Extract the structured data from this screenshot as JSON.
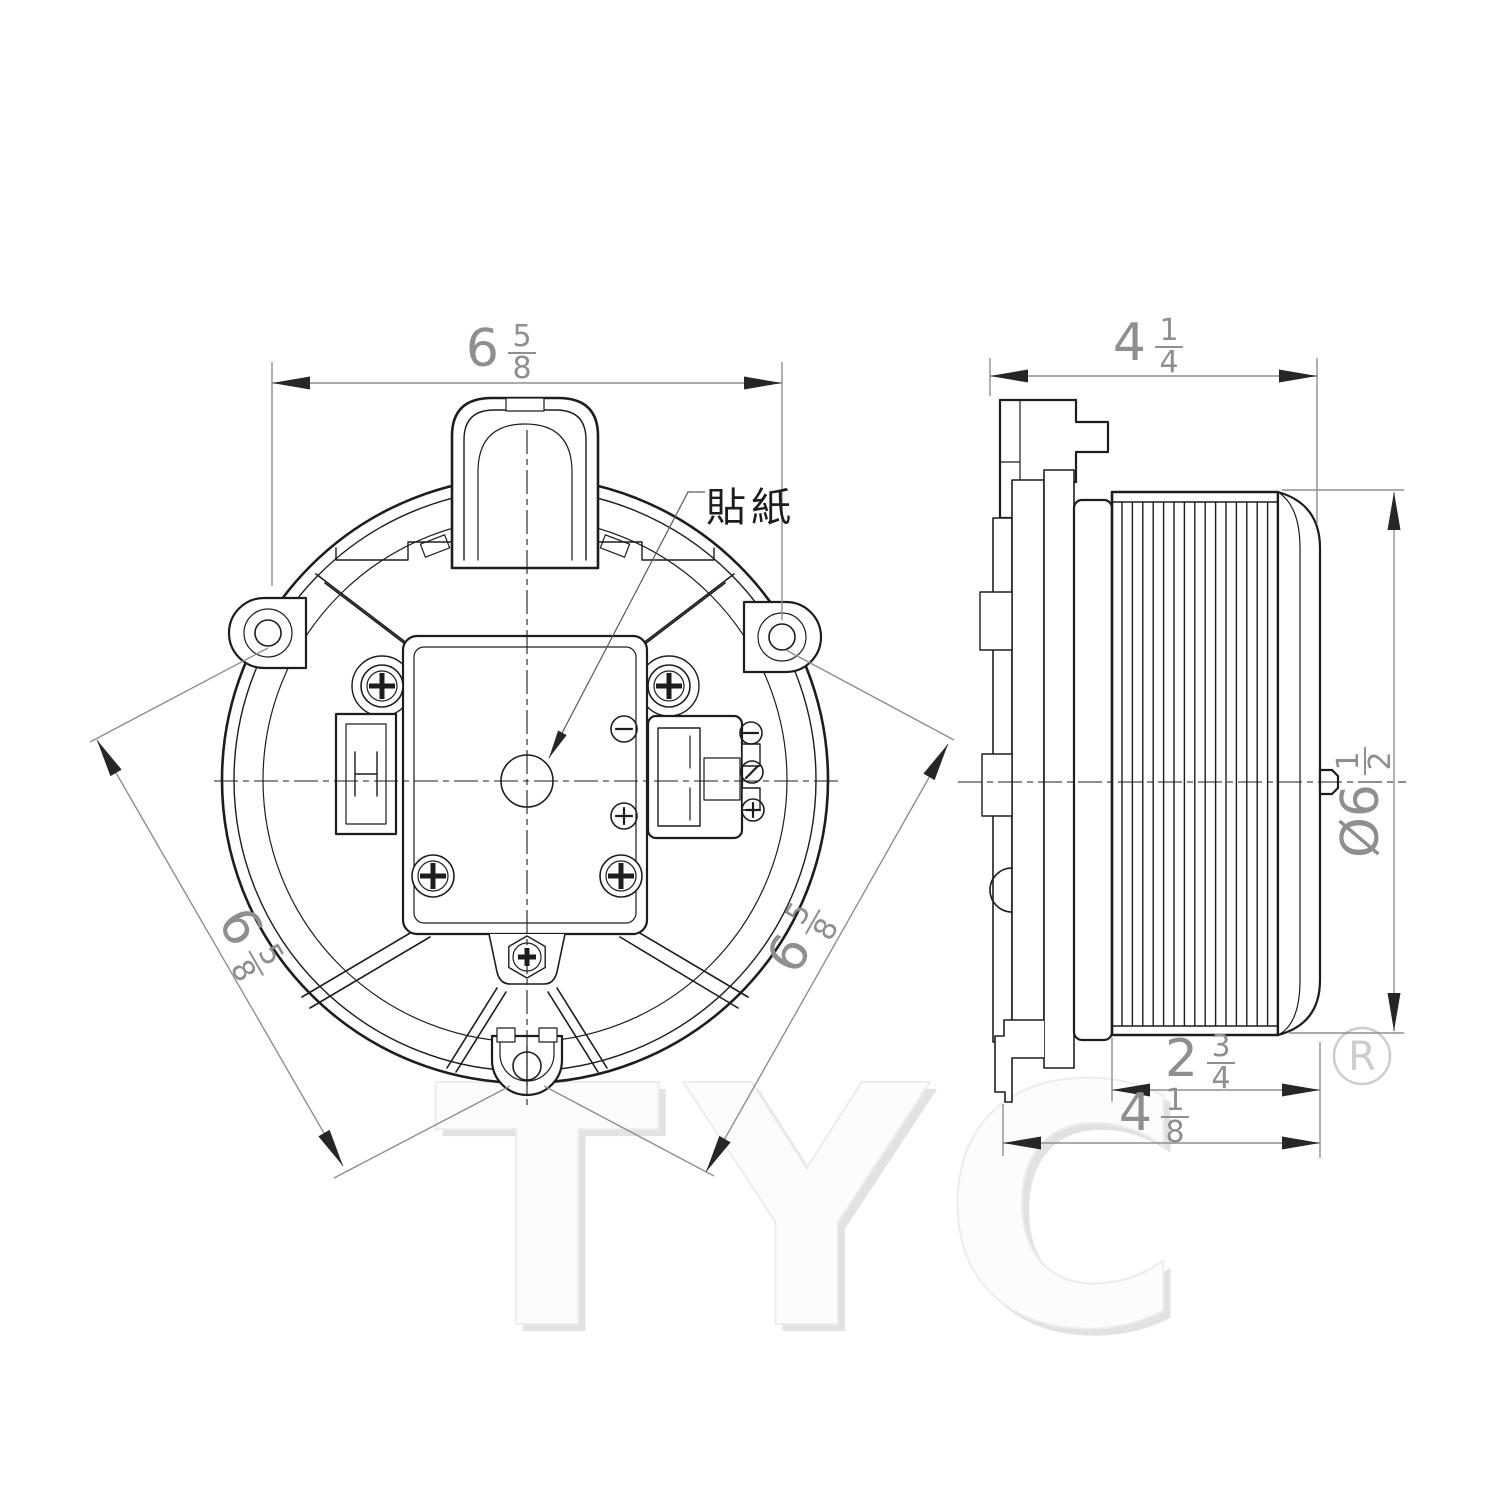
{
  "drawing": {
    "sticker_label": "貼紙",
    "watermark": "TYC",
    "registered_mark": "R",
    "dimensions": {
      "front_width": {
        "whole": "6",
        "num": "5",
        "den": "8"
      },
      "front_diag_left": {
        "whole": "6",
        "num": "5",
        "den": "8"
      },
      "front_diag_right": {
        "whole": "6",
        "num": "5",
        "den": "8"
      },
      "side_width": {
        "whole": "4",
        "num": "1",
        "den": "4"
      },
      "wheel_diameter": {
        "whole": "Ø6",
        "num": "1",
        "den": "2"
      },
      "wheel_depth": {
        "whole": "2",
        "num": "3",
        "den": "4"
      },
      "side_depth": {
        "whole": "4",
        "num": "1",
        "den": "8"
      }
    },
    "colors": {
      "background": "#ffffff",
      "line": "#1d1d1d",
      "dim": "#8f8f8f",
      "arrow": "#262626",
      "watermark_fill": "#fcfcfc",
      "watermark_shadow": "#e2e2e2",
      "registered": "#cdcdcd"
    }
  }
}
